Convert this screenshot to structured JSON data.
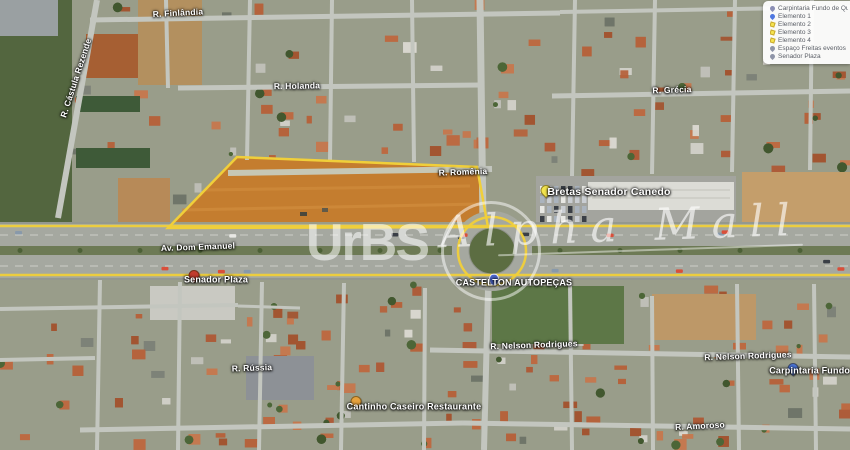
{
  "watermark": {
    "brand": "UrBS",
    "script": "Alpha Mall"
  },
  "legend": {
    "items": [
      {
        "label": "Carpintaria Fundo de Quintal",
        "icon": "purple-pin"
      },
      {
        "label": "Elemento 1",
        "icon": "blue-pin"
      },
      {
        "label": "Elemento 2",
        "icon": "yellow-shape"
      },
      {
        "label": "Elemento 3",
        "icon": "yellow-shape"
      },
      {
        "label": "Elemento 4",
        "icon": "yellow-shape"
      },
      {
        "label": "Espaço Freitas eventos",
        "icon": "grey-pin"
      },
      {
        "label": "Senador Plaza",
        "icon": "grey-pin"
      }
    ]
  },
  "map": {
    "street_labels": [
      {
        "label": "R. Finlândia",
        "x": 178,
        "y": 13,
        "rot": -3
      },
      {
        "label": "R. Cástula Rezende",
        "x": 76,
        "y": 78,
        "rot": -72
      },
      {
        "label": "R. Holanda",
        "x": 297,
        "y": 86,
        "rot": -1
      },
      {
        "label": "R. Grécia",
        "x": 672,
        "y": 90,
        "rot": -2
      },
      {
        "label": "R. Romênia",
        "x": 463,
        "y": 172,
        "rot": -2
      },
      {
        "label": "Av. Dom Emanuel",
        "x": 198,
        "y": 247,
        "rot": -2
      },
      {
        "label": "R. Nelson Rodrigues",
        "x": 534,
        "y": 345,
        "rot": -2
      },
      {
        "label": "R. Nelson Rodrigues",
        "x": 748,
        "y": 356,
        "rot": -2
      },
      {
        "label": "R. Rússia",
        "x": 252,
        "y": 368,
        "rot": -2
      },
      {
        "label": "R. Amoroso",
        "x": 700,
        "y": 426,
        "rot": -3
      }
    ],
    "poi_labels": [
      {
        "label": "Bretas Senador Canedo",
        "pin": "yellow",
        "pin_x": 546,
        "pin_y": 196,
        "x": 609,
        "y": 192,
        "emphasis": true
      },
      {
        "label": "Senador Plaza",
        "pin": "red",
        "pin_x": 194,
        "pin_y": 281,
        "x": 216,
        "y": 280,
        "emphasis": false
      },
      {
        "label": "CASTELTON AUTOPEÇAS",
        "pin": "blue-shield",
        "pin_x": 494,
        "pin_y": 281,
        "x": 514,
        "y": 283,
        "emphasis": false
      },
      {
        "label": "Cantinho Caseiro Restaurante",
        "pin": "orange",
        "pin_x": 356,
        "pin_y": 407,
        "x": 414,
        "y": 407,
        "emphasis": false
      },
      {
        "label": "Carpintaria Fundo de Quintal",
        "pin": "blue",
        "pin_x": 793,
        "pin_y": 374,
        "x": 834,
        "y": 371,
        "emphasis": false
      }
    ]
  },
  "colors": {
    "route_highlight": "#f0cf3a",
    "label_text": "#ffffff",
    "legend_text": "#5a5e66",
    "pins": {
      "yellow": "#f3e44e",
      "red": "#c23b2e",
      "blue": "#4a74d8",
      "orange": "#e6a23d",
      "blue-shield": "#4a64c8"
    }
  }
}
